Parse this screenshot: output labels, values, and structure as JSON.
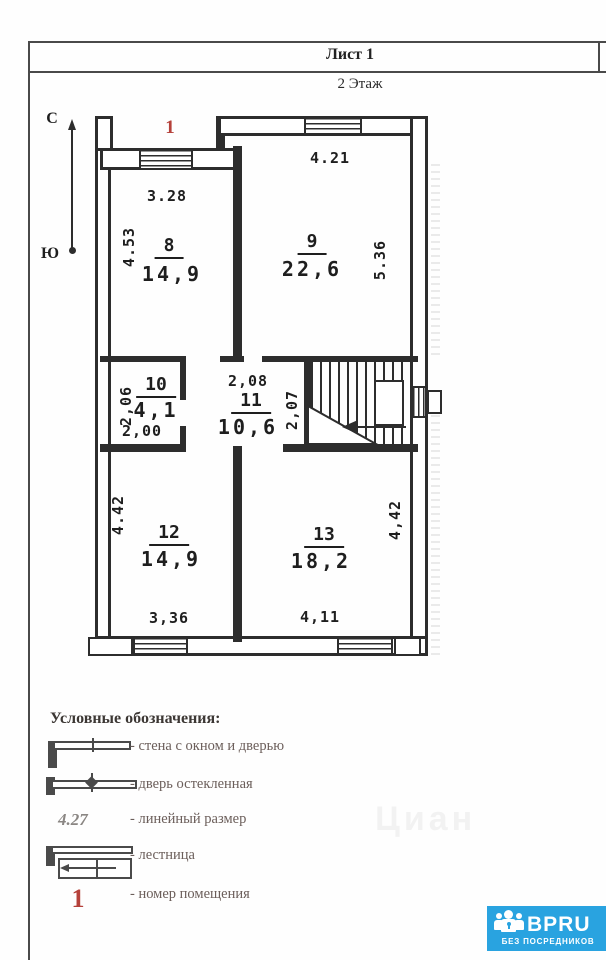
{
  "page": {
    "sheet_label": "Лист 1",
    "floor_label": "2 Этаж"
  },
  "compass": {
    "north": "С",
    "south": "Ю"
  },
  "plan": {
    "terrace_number": "1",
    "rooms": [
      {
        "number": "8",
        "area": "14,9",
        "dim_top": "3.28",
        "dim_left": "4.53"
      },
      {
        "number": "9",
        "area": "22,6",
        "dim_top": "4.21",
        "dim_right": "5.36"
      },
      {
        "number": "10",
        "area": "4,1",
        "dim_left": "2,06",
        "dim_bottom": "2,00"
      },
      {
        "number": "11",
        "area": "10,6",
        "dim_top": "2,08",
        "dim_right": "2,07"
      },
      {
        "number": "12",
        "area": "14,9",
        "dim_left": "4.42",
        "dim_bottom": "3,36"
      },
      {
        "number": "13",
        "area": "18,2",
        "dim_right": "4,42",
        "dim_bottom": "4,11"
      }
    ]
  },
  "legend": {
    "title": "Условные обозначения:",
    "items": [
      {
        "label": "- стена с окном и дверью"
      },
      {
        "label": "- дверь остекленная"
      },
      {
        "sample": "4.27",
        "label": "- линейный размер"
      },
      {
        "label": "- лестница"
      },
      {
        "sample": "1",
        "label": "- номер помещения"
      }
    ]
  },
  "badge": {
    "brand": "BPRU",
    "tagline": "БЕЗ ПОСРЕДНИКОВ",
    "color": "#29a3e0"
  },
  "faint_watermark": "Циан",
  "colors": {
    "room_number_red": "#b5413a",
    "wall": "#2d2d2d"
  }
}
